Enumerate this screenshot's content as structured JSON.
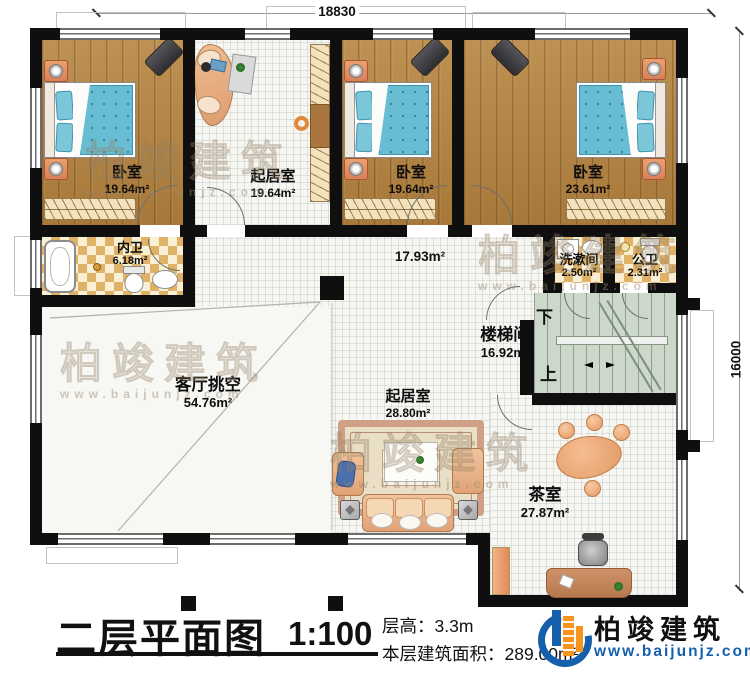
{
  "plan": {
    "title": "二层平面图",
    "scale": "1:100",
    "rooms": [
      {
        "id": "bedroom-1",
        "name": "卧室",
        "area": "19.64m²"
      },
      {
        "id": "study",
        "name": "起居室",
        "area": "19.64m²"
      },
      {
        "id": "bedroom-2",
        "name": "卧室",
        "area": "19.64m²"
      },
      {
        "id": "bedroom-3",
        "name": "卧室",
        "area": "23.61m²"
      },
      {
        "id": "inner-bath",
        "name": "内卫",
        "area": "6.18m²"
      },
      {
        "id": "hallway",
        "name": "",
        "area": "17.93m²"
      },
      {
        "id": "washroom",
        "name": "洗漱间",
        "area": "2.50m²"
      },
      {
        "id": "public-bath",
        "name": "公卫",
        "area": "2.31m²"
      },
      {
        "id": "stairwell",
        "name": "楼梯间",
        "area": "16.92m²"
      },
      {
        "id": "living-void",
        "name": "客厅挑空",
        "area": "54.76m²"
      },
      {
        "id": "living-room",
        "name": "起居室",
        "area": "28.80m²"
      },
      {
        "id": "tea-room",
        "name": "茶室",
        "area": "27.87m²"
      }
    ],
    "stairs": {
      "down_label": "下",
      "up_label": "上"
    },
    "dimensions": {
      "top": "18830",
      "right": "16000"
    },
    "annotations": {
      "floor_height": "层高：3.3m",
      "floor_area": "本层建筑面积：289.00m²"
    }
  },
  "branding": {
    "company": "柏竣建筑",
    "website": "www.baijunjz.com"
  },
  "watermark": {
    "text": "柏竣建筑",
    "subtext": "www.baijunjz.com"
  },
  "colors": {
    "wall": "#0f0f0f",
    "wood_floor": "#b2823f",
    "mattress": "#68bdd3",
    "checker_tile": "#e0b267",
    "stair_floor": "#ccd8ca",
    "brand_blue": "#1460ad",
    "brand_orange": "#f7941d"
  }
}
